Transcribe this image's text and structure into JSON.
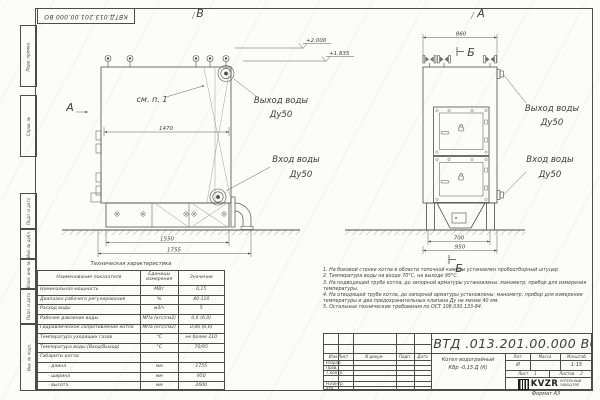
{
  "frame": {
    "doc_number_top": "КВТД.013.201.00.000  ВО",
    "margin_labels": {
      "m1": "Перв. примен.",
      "m2": "Справ. №",
      "m3": "Подп. и дата",
      "m4": "Инв. № дубл.",
      "m5": "Взам. инв. №",
      "m6": "Подп. и дата",
      "m7": "Инв. № подл."
    },
    "format_note": "Формат  А3"
  },
  "views": {
    "left_view_label": "В",
    "right_view_label": "А",
    "view_arrow_label": "А",
    "section_mark_top": "Б",
    "section_mark_bottom": "Б",
    "see_item_note": "см. п. 1",
    "elevation_1": "+2.000",
    "elevation_2": "+1.835",
    "outlet_left_line1": "Выход воды",
    "outlet_left_line2": "Ду50",
    "inlet_left_line1": "Вход воды",
    "inlet_left_line2": "Ду50",
    "outlet_right_line1": "Выход воды",
    "outlet_right_line2": "Ду50",
    "inlet_right_line1": "Вход воды",
    "inlet_right_line2": "Ду50",
    "dim_width_inner": "1470",
    "dim_base": "1550",
    "dim_length": "1755",
    "dim_front_top": "860",
    "dim_front_base": "700",
    "dim_front_width": "950"
  },
  "spec_table": {
    "title": "Техническая характеристика",
    "col1": "Наименование показателя",
    "col2a": "Единицы",
    "col2b": "измерения",
    "col3": "Значение",
    "rows": [
      [
        "Номинальная мощность",
        "МВт",
        "0,15"
      ],
      [
        "Диапазон рабочего регулирования",
        "%",
        "40-110"
      ],
      [
        "Расход воды",
        "м3/ч",
        "5"
      ],
      [
        "Рабочее давление воды",
        "МПа (кгс/см2)",
        "0,6 (6,0)"
      ],
      [
        "Гидравлическое сопротивление котла",
        "МПа (кгс/см2)",
        "0,06 (0,6)"
      ],
      [
        "Температура уходящих газов",
        "°С",
        "не более 210"
      ],
      [
        "Температура воды (Вход/Выход)",
        "°С",
        "70/95"
      ],
      [
        "Габариты котла",
        "",
        ""
      ],
      [
        "- длина",
        "мм",
        "1755"
      ],
      [
        "- ширина",
        "мм",
        "950"
      ],
      [
        "- высота",
        "мм",
        "2600"
      ]
    ]
  },
  "notes": [
    "1.  На боковой стенке котла в области топочной камеры установлен пробоотборный штуцер",
    "2.  Температура воды на входе 70°С, на выходе 95°С.",
    "3.  На подводящей трубе котла, до запорной арматуры установлены: манометр, прибор для измерения температуры.",
    "4.  На отводящей трубе котла, до запорной арматуры установлены: манометр, прибор для измерения температуры и два предохранительных клапана Ду не менее 40 мм.",
    "5.  Остальные технические требования по ОСТ 108.030.133-84."
  ],
  "title_block": {
    "doc_number": "КВТД .013.201.00.000  ВО",
    "product_line1": "Котел водогрейный",
    "product_line2": "КВр -0,15  Д  (К)",
    "lit_label": "Лит.",
    "mass_label": "Масса",
    "scale_label": "Масштаб",
    "lit_value": "И",
    "mass_value": "",
    "scale_value": "1:15",
    "sheet_label": "Лист",
    "sheet_value": "1",
    "sheets_label": "Листов",
    "sheets_value": "2",
    "cols": {
      "c1": "Изм.Лист",
      "c2": "N докум.",
      "c3": "Подп.",
      "c4": "Дата"
    },
    "rows": {
      "r1": "Разраб.",
      "r2": "Пров.",
      "r3": "Т.контр.",
      "r4": "Н.контр.",
      "r5": "Утв."
    },
    "logo": {
      "name": "KVZR",
      "sub1": "КОТЕЛЬНЫЙ",
      "sub2": "ЗАВОД РЭП"
    }
  }
}
